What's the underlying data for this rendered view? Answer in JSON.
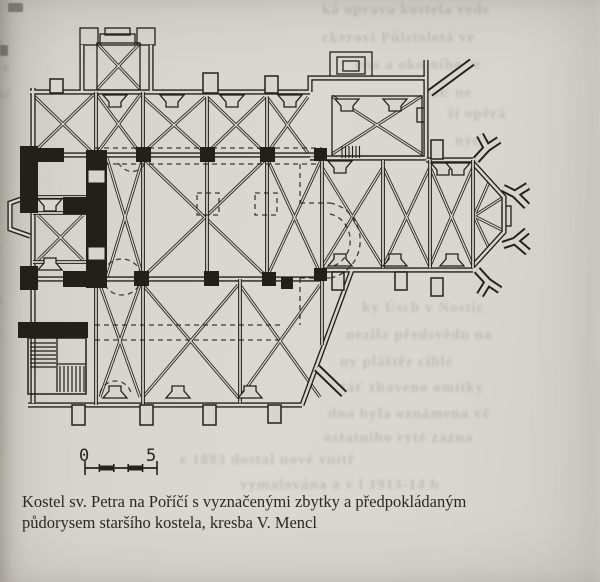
{
  "page": {
    "paper": "#d8d5cf",
    "ink": "#23201b"
  },
  "caption": {
    "line1": "Kostel sv. Petra na Poříčí s vyznačenými zbytky a předpokládaným",
    "line2": "půdorysem staršího kostela, kresba V. Mencl"
  },
  "scale_bar": {
    "start_label": "0",
    "end_label": "5"
  },
  "bleed_through": {
    "color": "#55614d",
    "fragments": [
      "ká oprava kostela  vede",
      "ckerovi  Půlstoletá ve",
      "ena a  okolního se",
      "SE  ne",
      "ší opěrá",
      "ných",
      "ky Úsch v Nostic",
      "nezila předsvědn na",
      "ny  pláštěr  cihle",
      "stáť zbaveno omítky",
      "dna byla oznámena  vě",
      "ostatního  ryté  zazna",
      "r  1883  dostal  nové  vnitř",
      "vymalována a v l  1913-14 b"
    ],
    "margin": [
      "a",
      "ve",
      "ne",
      "í",
      "c",
      "S",
      "e",
      "v"
    ]
  }
}
